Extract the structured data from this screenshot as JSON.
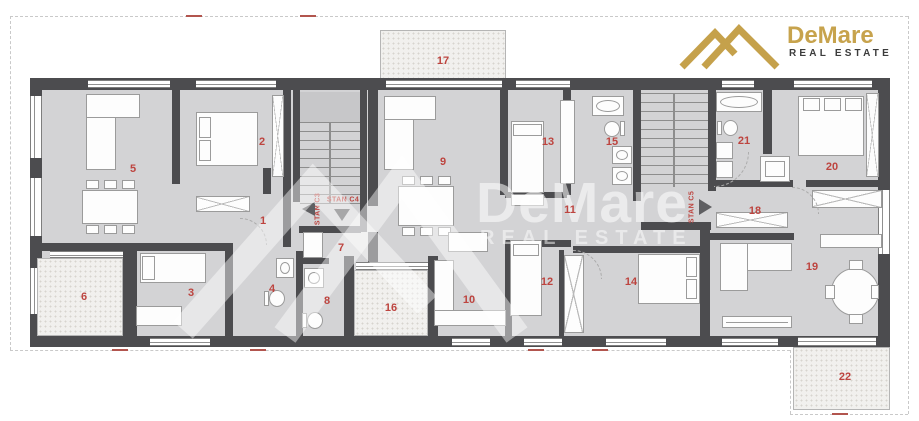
{
  "header_logo": {
    "brand": "DeMare",
    "tagline": "REAL ESTATE",
    "brand_color": "#c7a34d",
    "tagline_color": "#3c3c3c"
  },
  "watermark": {
    "brand": "DeMare",
    "tagline": "REAL ESTATE"
  },
  "plan": {
    "unit_labels": [
      {
        "id": "C3",
        "label": "STAN C3",
        "arrow": "left"
      },
      {
        "id": "C4",
        "label": "STAN C4",
        "arrow": "down"
      },
      {
        "id": "C5",
        "label": "STAN C5",
        "arrow": "right"
      }
    ],
    "rooms": [
      {
        "number": "1",
        "x": 263,
        "y": 221
      },
      {
        "number": "2",
        "x": 262,
        "y": 142
      },
      {
        "number": "3",
        "x": 191,
        "y": 293
      },
      {
        "number": "4",
        "x": 272,
        "y": 289
      },
      {
        "number": "5",
        "x": 133,
        "y": 169
      },
      {
        "number": "6",
        "x": 84,
        "y": 297
      },
      {
        "number": "7",
        "x": 341,
        "y": 248
      },
      {
        "number": "8",
        "x": 327,
        "y": 301
      },
      {
        "number": "9",
        "x": 443,
        "y": 162
      },
      {
        "number": "10",
        "x": 469,
        "y": 300
      },
      {
        "number": "11",
        "x": 570,
        "y": 210
      },
      {
        "number": "12",
        "x": 547,
        "y": 282
      },
      {
        "number": "13",
        "x": 548,
        "y": 142
      },
      {
        "number": "14",
        "x": 631,
        "y": 282
      },
      {
        "number": "15",
        "x": 612,
        "y": 142
      },
      {
        "number": "16",
        "x": 391,
        "y": 308
      },
      {
        "number": "17",
        "x": 443,
        "y": 61
      },
      {
        "number": "18",
        "x": 755,
        "y": 211
      },
      {
        "number": "19",
        "x": 812,
        "y": 267
      },
      {
        "number": "20",
        "x": 832,
        "y": 167
      },
      {
        "number": "21",
        "x": 744,
        "y": 141
      },
      {
        "number": "22",
        "x": 845,
        "y": 377
      }
    ],
    "colors": {
      "wall": "#4c4c4f",
      "floor": "#d3d3d5",
      "room_label": "#bd443f",
      "terrace_bg": "#f1f0ee",
      "boundary_dash": "#c9c9c9",
      "boundary_red_dash": "#b2554e"
    }
  }
}
